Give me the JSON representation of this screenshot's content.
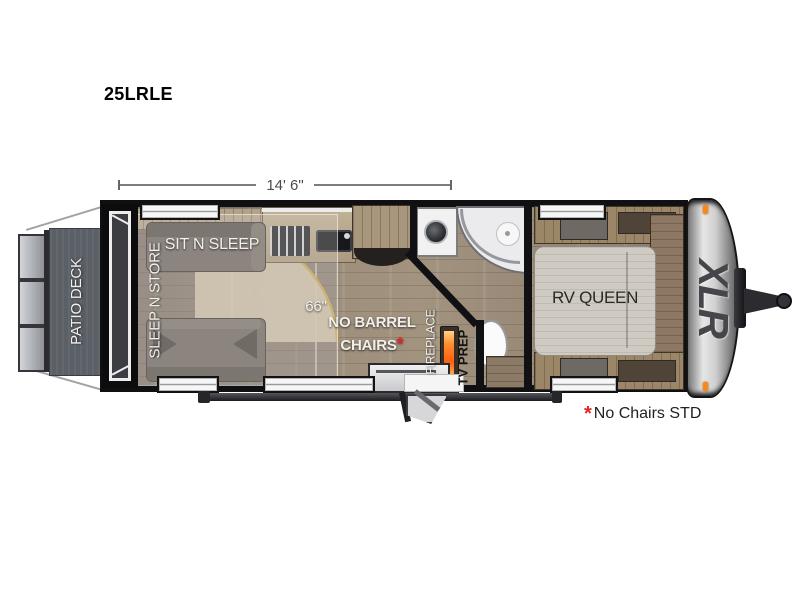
{
  "title": "25LRLE",
  "dimension": {
    "label": "14' 6\""
  },
  "floorplan": {
    "patio_deck": "PATIO DECK",
    "sleep_n_store": "SLEEP N STORE",
    "sit_n_sleep": "SIT N SLEEP",
    "slide_width": "66\"",
    "no_barrel_line1": "NO BARREL",
    "no_barrel_line2": "CHAIRS",
    "no_barrel_asterisk": "*",
    "fireplace": "FIREPLACE",
    "tv_prep": "TV PREP",
    "rv_queen": "RV QUEEN",
    "brand": "XLR"
  },
  "footnote": {
    "asterisk": "*",
    "text": "No Chairs STD"
  },
  "colors": {
    "wall": "#111113",
    "floor": "#998a78",
    "deck": "#5b5f66",
    "marker_orange": "#f28a1f",
    "flame_orange": "#ff6a1a",
    "note_red": "#e02525",
    "mattress": "#cfcbc2",
    "front_cap_silver": "#c6c6c6",
    "bed_arc_gold": "#c9a84e"
  }
}
